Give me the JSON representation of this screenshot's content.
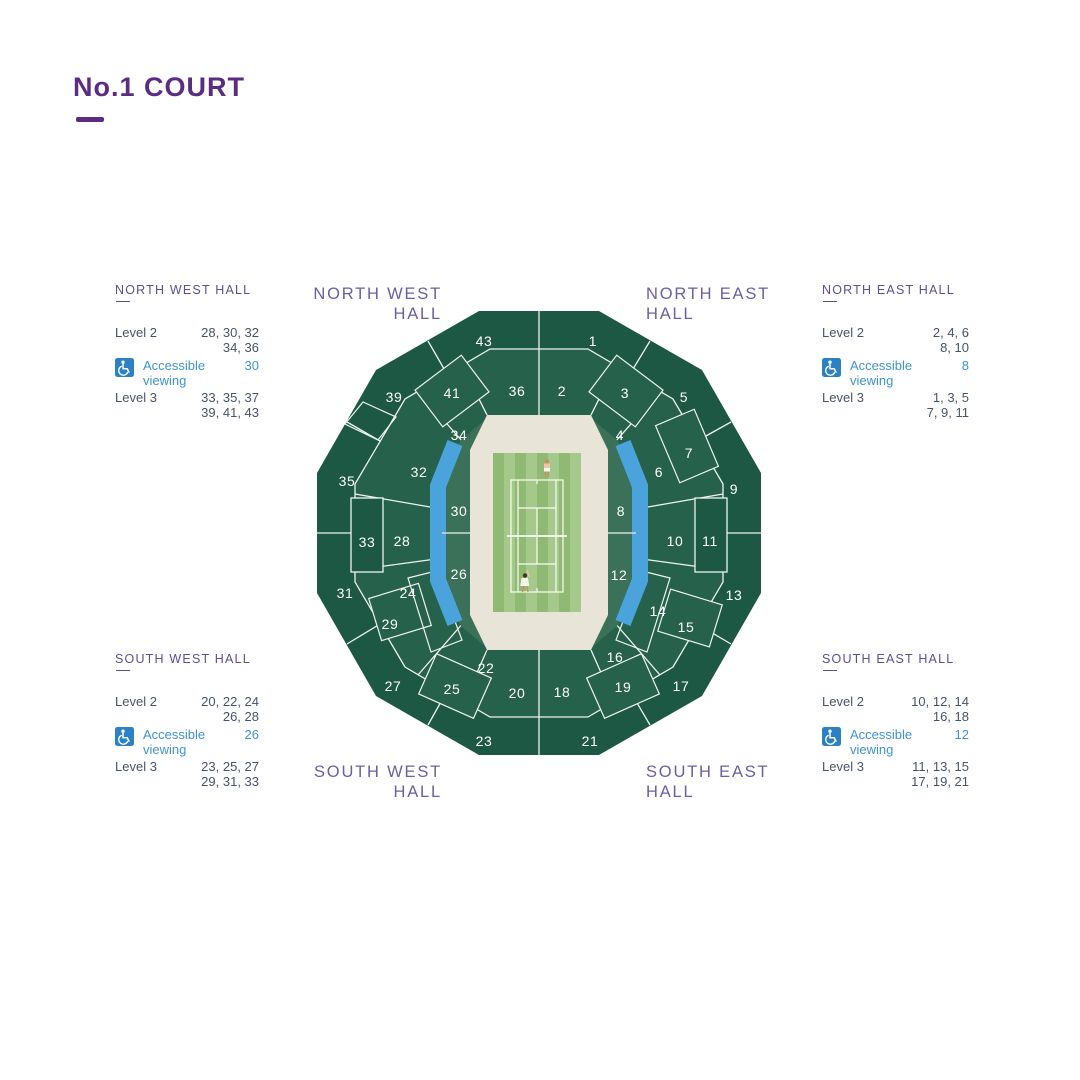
{
  "title": {
    "text": "No.1 COURT"
  },
  "halls": {
    "north_west": {
      "line1": "NORTH WEST",
      "line2": "HALL"
    },
    "north_east": {
      "line1": "NORTH EAST",
      "line2": "HALL"
    },
    "south_west": {
      "line1": "SOUTH WEST",
      "line2": "HALL"
    },
    "south_east": {
      "line1": "SOUTH EAST",
      "line2": "HALL"
    }
  },
  "panels": [
    {
      "header": "NORTH WEST HALL",
      "level2_label": "Level 2",
      "level2_value": "28, 30, 32\n34, 36",
      "accessible_label": "Accessible\nviewing",
      "accessible_value": "30",
      "level3_label": "Level 3",
      "level3_value": "33, 35, 37\n39, 41, 43"
    },
    {
      "header": "NORTH EAST HALL",
      "level2_label": "Level 2",
      "level2_value": "2, 4, 6\n8, 10",
      "accessible_label": "Accessible\nviewing",
      "accessible_value": "8",
      "level3_label": "Level 3",
      "level3_value": "1, 3, 5\n7, 9, 11"
    },
    {
      "header": "SOUTH WEST HALL",
      "level2_label": "Level 2",
      "level2_value": "20, 22, 24\n26, 28",
      "accessible_label": "Accessible\nviewing",
      "accessible_value": "26",
      "level3_label": "Level 3",
      "level3_value": "23, 25, 27\n29, 31, 33"
    },
    {
      "header": "SOUTH EAST HALL",
      "level2_label": "Level 2",
      "level2_value": "10, 12, 14\n16, 18",
      "accessible_label": "Accessible\nviewing",
      "accessible_value": "12",
      "level3_label": "Level 3",
      "level3_value": "11, 13, 15\n17, 19, 21"
    }
  ],
  "map": {
    "sections": [
      {
        "n": "43",
        "x": 484,
        "y": 341
      },
      {
        "n": "1",
        "x": 593,
        "y": 341
      },
      {
        "n": "39",
        "x": 394,
        "y": 397
      },
      {
        "n": "41",
        "x": 452,
        "y": 393
      },
      {
        "n": "36",
        "x": 517,
        "y": 391
      },
      {
        "n": "2",
        "x": 562,
        "y": 391
      },
      {
        "n": "3",
        "x": 625,
        "y": 393
      },
      {
        "n": "5",
        "x": 684,
        "y": 397
      },
      {
        "n": "35",
        "x": 347,
        "y": 481
      },
      {
        "n": "34",
        "x": 459,
        "y": 435
      },
      {
        "n": "4",
        "x": 620,
        "y": 435
      },
      {
        "n": "7",
        "x": 689,
        "y": 453
      },
      {
        "n": "9",
        "x": 734,
        "y": 489
      },
      {
        "n": "32",
        "x": 419,
        "y": 472
      },
      {
        "n": "30",
        "x": 459,
        "y": 511
      },
      {
        "n": "8",
        "x": 621,
        "y": 511
      },
      {
        "n": "6",
        "x": 659,
        "y": 472
      },
      {
        "n": "33",
        "x": 367,
        "y": 542
      },
      {
        "n": "28",
        "x": 402,
        "y": 541
      },
      {
        "n": "10",
        "x": 675,
        "y": 541
      },
      {
        "n": "11",
        "x": 710,
        "y": 541
      },
      {
        "n": "31",
        "x": 345,
        "y": 593
      },
      {
        "n": "26",
        "x": 459,
        "y": 574
      },
      {
        "n": "12",
        "x": 619,
        "y": 575
      },
      {
        "n": "13",
        "x": 734,
        "y": 595
      },
      {
        "n": "24",
        "x": 408,
        "y": 593
      },
      {
        "n": "14",
        "x": 658,
        "y": 611
      },
      {
        "n": "29",
        "x": 390,
        "y": 624
      },
      {
        "n": "15",
        "x": 686,
        "y": 627
      },
      {
        "n": "27",
        "x": 393,
        "y": 686
      },
      {
        "n": "25",
        "x": 452,
        "y": 689
      },
      {
        "n": "22",
        "x": 486,
        "y": 668
      },
      {
        "n": "20",
        "x": 517,
        "y": 693
      },
      {
        "n": "18",
        "x": 562,
        "y": 692
      },
      {
        "n": "16",
        "x": 615,
        "y": 657
      },
      {
        "n": "19",
        "x": 623,
        "y": 687
      },
      {
        "n": "17",
        "x": 681,
        "y": 686
      },
      {
        "n": "23",
        "x": 484,
        "y": 741
      },
      {
        "n": "21",
        "x": 590,
        "y": 741
      }
    ],
    "colors": {
      "accent_purple": "#5A2D82",
      "hall_label_purple": "#6A5F9F",
      "panel_header_purple": "#5C4E92",
      "body_text": "#475366",
      "accessible_blue": "#3F93CC",
      "accessible_icon_bg": "#2C80C4",
      "stadium_green_outer": "#1C5843",
      "stadium_green_inner": "#25614B",
      "accessible_section_blue": "#4AA3DB",
      "bowl_cream": "#E8E4D7",
      "court_stripe_light": "#A4C98A",
      "court_stripe_dark": "#90BA74"
    }
  }
}
